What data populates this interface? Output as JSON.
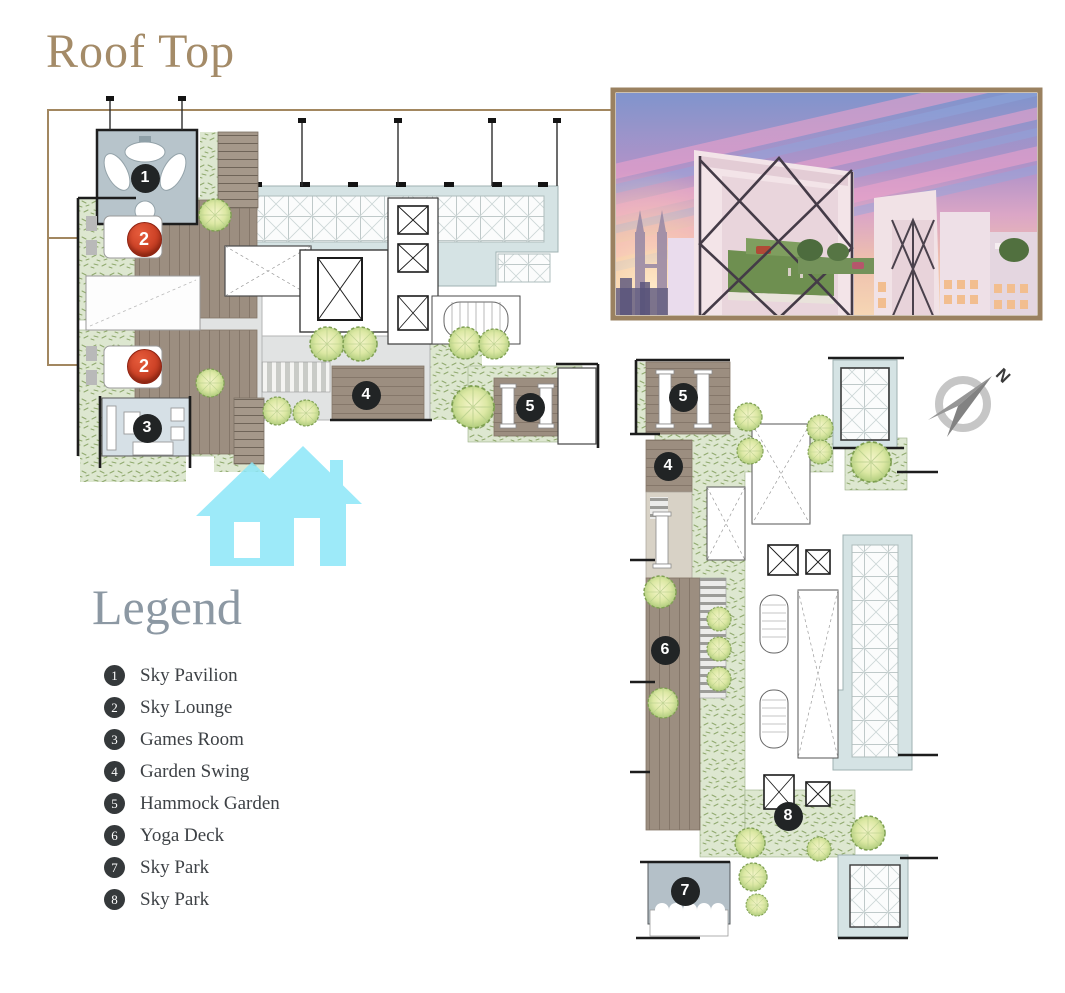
{
  "page": {
    "title": "Roof Top",
    "compass_label": "N"
  },
  "legend": {
    "heading": "Legend",
    "items": [
      {
        "number": "1",
        "label": "Sky Pavilion"
      },
      {
        "number": "2",
        "label": "Sky Lounge"
      },
      {
        "number": "3",
        "label": "Games Room"
      },
      {
        "number": "4",
        "label": "Garden Swing"
      },
      {
        "number": "5",
        "label": "Hammock Garden"
      },
      {
        "number": "6",
        "label": "Yoga Deck"
      },
      {
        "number": "7",
        "label": "Sky Park"
      },
      {
        "number": "8",
        "label": "Sky Park"
      }
    ]
  },
  "markers": {
    "left": [
      {
        "number": "1",
        "label": "Sky Pavilion",
        "style": "black"
      },
      {
        "number": "2",
        "label": "Sky Lounge",
        "style": "red"
      },
      {
        "number": "2",
        "label": "Sky Lounge",
        "style": "red"
      },
      {
        "number": "3",
        "label": "Games Room",
        "style": "black"
      },
      {
        "number": "4",
        "label": "Garden Swing",
        "style": "black"
      },
      {
        "number": "5",
        "label": "Hammock Garden",
        "style": "black"
      }
    ],
    "right": [
      {
        "number": "5",
        "label": "Hammock Garden",
        "style": "black"
      },
      {
        "number": "4",
        "label": "Garden Swing",
        "style": "black"
      },
      {
        "number": "6",
        "label": "Yoga Deck",
        "style": "black"
      },
      {
        "number": "8",
        "label": "Sky Park",
        "style": "black"
      },
      {
        "number": "7",
        "label": "Sky Deck",
        "style": "black"
      }
    ]
  },
  "colors": {
    "title": "#A48B68",
    "legend_heading": "#8C98A3",
    "marker_black": "#212425",
    "marker_red": "#C23B22",
    "callout_frame": "#A28760",
    "photo_frame": "#9A8160",
    "garden_green": "#DDE7D0",
    "deck_brown": "#9C8E80",
    "glass_blue": "#D5E3E4",
    "watermark_cyan": "#8DE7F8"
  }
}
